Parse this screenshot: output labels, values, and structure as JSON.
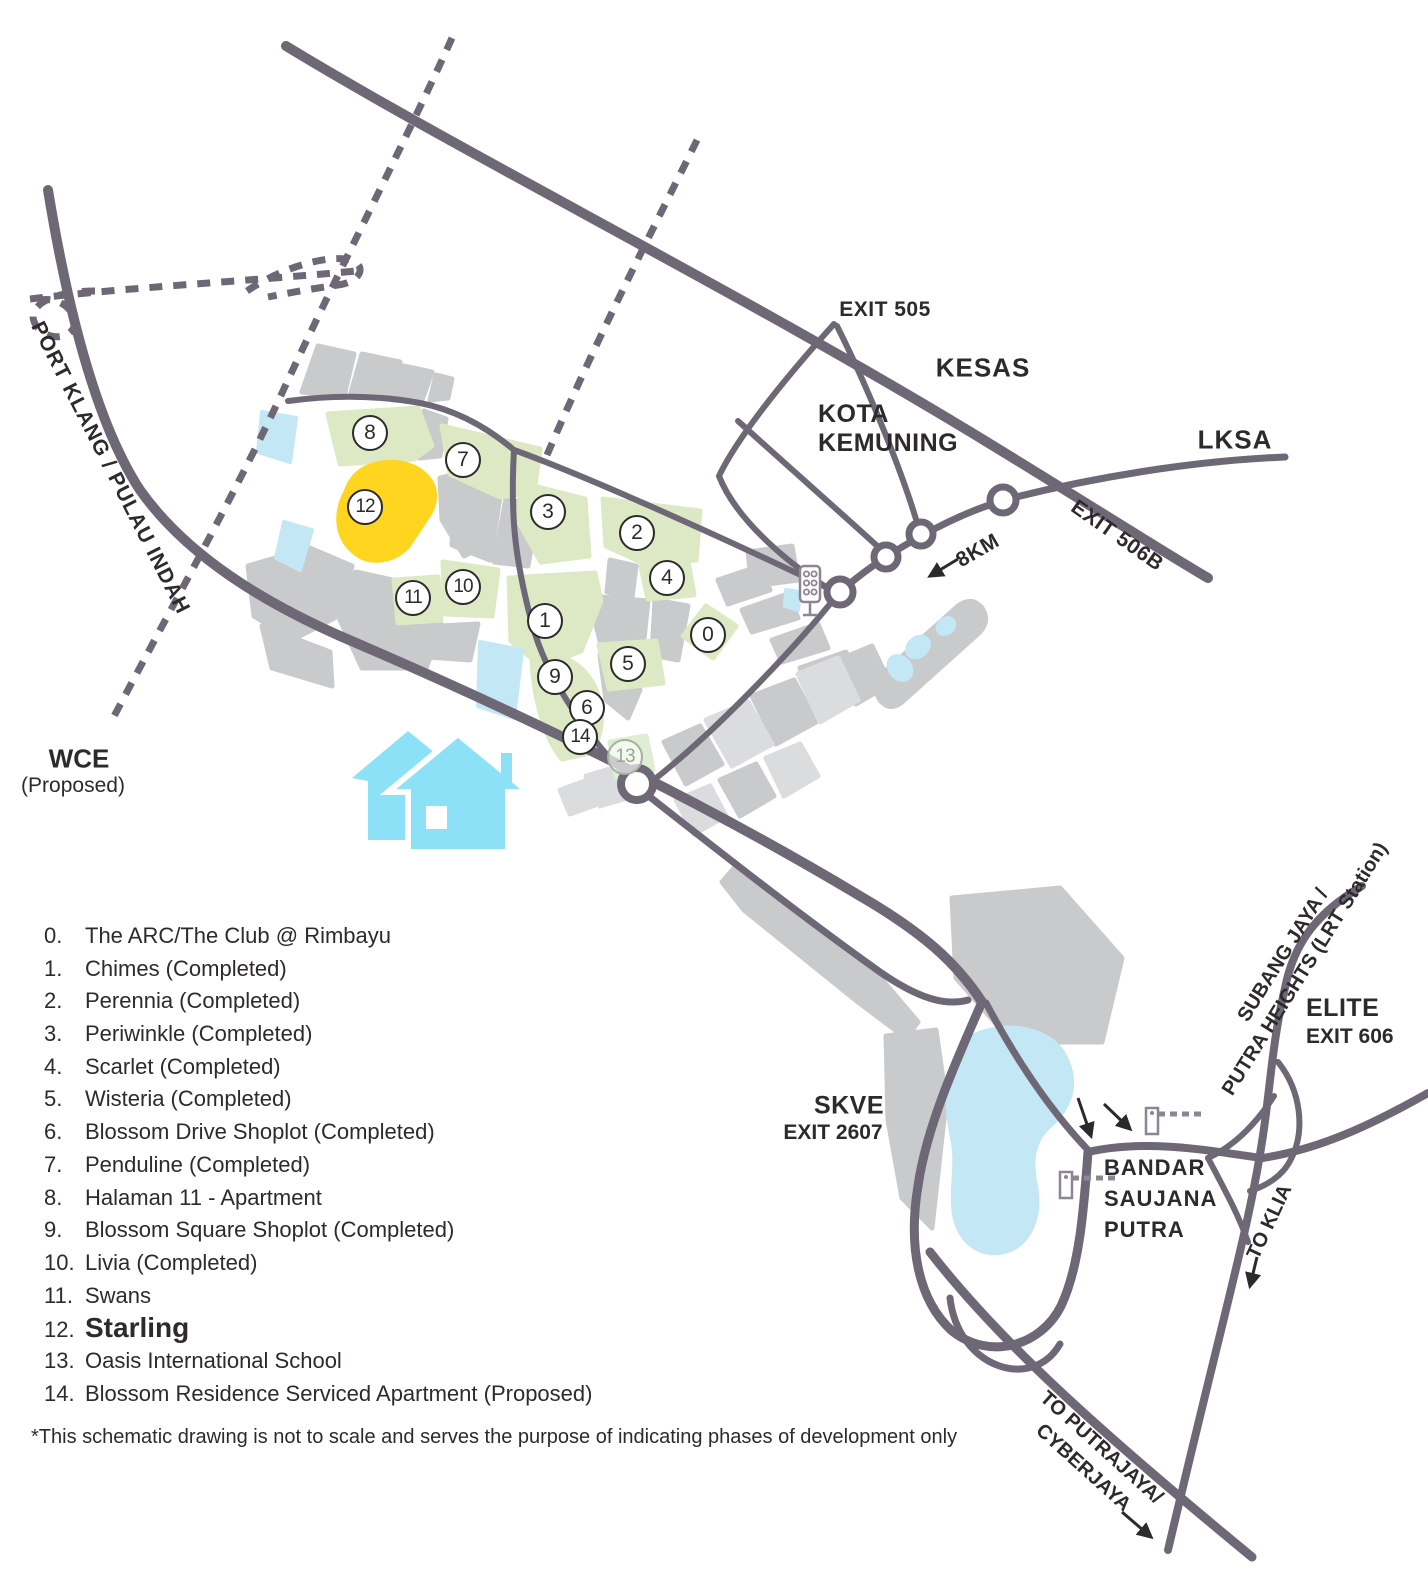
{
  "map_labels": {
    "exit505": "EXIT 505",
    "kesas": "KESAS",
    "kota_kemuning_line1": "KOTA",
    "kota_kemuning_line2": "KEMUNING",
    "lksa": "LKSA",
    "exit506b": "EXIT 506B",
    "distance_8km": "8KM",
    "port_klang": "PORT KLANG / PULAU INDAH",
    "wce": "WCE",
    "wce_note": "(Proposed)",
    "skve": "SKVE",
    "skve_exit": "EXIT 2607",
    "bandar_line1": "BANDAR",
    "bandar_line2": "SAUJANA",
    "bandar_line3": "PUTRA",
    "subang_line1": "SUBANG JAYA /",
    "subang_line2": "PUTRA HEIGHTS (LRT Station)",
    "elite": "ELITE",
    "elite_exit": "EXIT 606",
    "to_klia": "TO KLIA",
    "putrajaya_line1": "TO PUTRAJAYA/",
    "putrajaya_line2": "CYBERJAYA"
  },
  "markers": [
    {
      "n": "0"
    },
    {
      "n": "1"
    },
    {
      "n": "2"
    },
    {
      "n": "3"
    },
    {
      "n": "4"
    },
    {
      "n": "5"
    },
    {
      "n": "6"
    },
    {
      "n": "7"
    },
    {
      "n": "8"
    },
    {
      "n": "9"
    },
    {
      "n": "10"
    },
    {
      "n": "11"
    },
    {
      "n": "12"
    },
    {
      "n": "13"
    },
    {
      "n": "14"
    }
  ],
  "legend": {
    "items": [
      {
        "num": "0.",
        "label": "The ARC/The Club @ Rimbayu"
      },
      {
        "num": "1.",
        "label": "Chimes (Completed)"
      },
      {
        "num": "2.",
        "label": "Perennia (Completed)"
      },
      {
        "num": "3.",
        "label": "Periwinkle (Completed)"
      },
      {
        "num": "4.",
        "label": "Scarlet (Completed)"
      },
      {
        "num": "5.",
        "label": "Wisteria (Completed)"
      },
      {
        "num": "6.",
        "label": "Blossom Drive Shoplot (Completed)"
      },
      {
        "num": "7.",
        "label": "Penduline (Completed)"
      },
      {
        "num": "8.",
        "label": "Halaman 11 - Apartment"
      },
      {
        "num": "9.",
        "label": "Blossom Square Shoplot (Completed)"
      },
      {
        "num": "10.",
        "label": "Livia (Completed)"
      },
      {
        "num": "11.",
        "label": "Swans"
      },
      {
        "num": "12.",
        "label": "Starling"
      },
      {
        "num": "13.",
        "label": "Oasis International School"
      },
      {
        "num": "14.",
        "label": "Blossom Residence Serviced Apartment (Proposed)"
      }
    ]
  },
  "footnote": "*This schematic drawing is not to scale and serves the purpose of indicating phases of development only",
  "colors": {
    "road": "#6E6876",
    "parcel_green": "#DDE9C5",
    "parcel_green_faded": "#DFEDD2",
    "parcel_gray": "#C9CACC",
    "parcel_gray_light": "#DBDCDE",
    "water": "#C3E7F5",
    "highlight_yellow": "#FFD520",
    "house_icon": "#8CE1F7",
    "text": "#2D2A2B"
  }
}
